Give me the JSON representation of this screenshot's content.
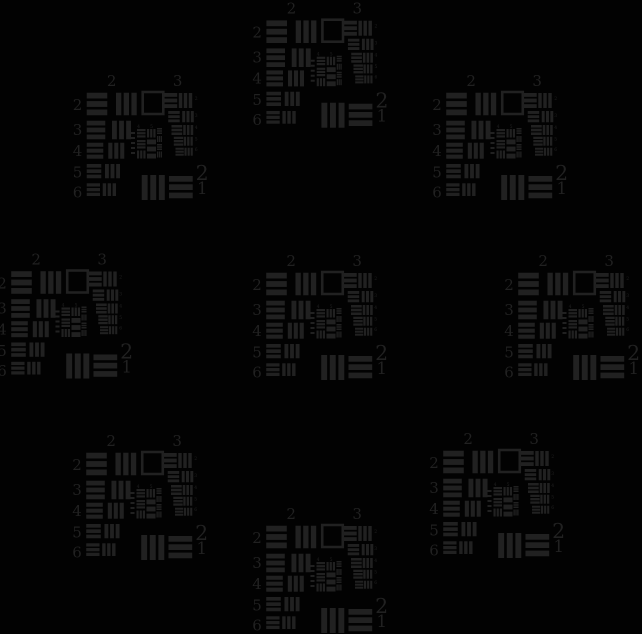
{
  "image": {
    "width": 642,
    "height": 634,
    "background": "#020202",
    "ink": "#212121",
    "description": "USAF 1951 resolution test target tile repeated at 9 positions (center plus ring of 8) on a black background"
  },
  "tile": {
    "width": 140,
    "height": 126,
    "labels": {
      "font_size": 15,
      "top": [
        {
          "text": "2",
          "x": 39.2,
          "y": 11
        },
        {
          "text": "3",
          "x": 105.1,
          "y": 11
        }
      ],
      "left": [
        {
          "text": "2",
          "x": 0.2,
          "y": 35
        },
        {
          "text": "3",
          "x": 0.2,
          "y": 60
        },
        {
          "text": "4",
          "x": 0.2,
          "y": 81
        },
        {
          "text": "5",
          "x": 0.2,
          "y": 102.3
        },
        {
          "text": "6",
          "x": 0.2,
          "y": 122.3
        }
      ],
      "corner": [
        {
          "text": "2",
          "x": 129.7,
          "y": 105,
          "size": 20.5
        },
        {
          "text": "1",
          "x": 129.7,
          "y": 119,
          "size": 16.5
        }
      ],
      "right_ticks": {
        "size": 4.5,
        "x": 122.3,
        "items": [
          {
            "text": "2",
            "y": 25
          },
          {
            "text": "3",
            "y": 42
          },
          {
            "text": "4",
            "y": 54
          },
          {
            "text": "5",
            "y": 65.5
          },
          {
            "text": "6",
            "y": 76
          }
        ]
      },
      "cluster": {
        "size": 4.5,
        "items": [
          {
            "text": "4",
            "x": 66,
            "y": 53
          },
          {
            "text": "5",
            "x": 79,
            "y": 53
          }
        ]
      }
    },
    "open_square": {
      "x": 70.2,
      "y": 17,
      "w": 20.6,
      "h": 22,
      "stroke": 2.6
    },
    "bar_geometry": {
      "bar_fraction": 0.2564,
      "gap_fraction": 0.1154
    },
    "bar_blocks": {
      "group2": [
        {
          "type": "h",
          "x": 14.2,
          "y": 17.7,
          "w": 20.6,
          "h": 22.6
        },
        {
          "type": "v",
          "x": 43.5,
          "y": 17.7,
          "w": 20.7,
          "h": 22.6
        },
        {
          "type": "h",
          "x": 14.2,
          "y": 45.7,
          "w": 18.6,
          "h": 18.6
        },
        {
          "type": "v",
          "x": 39.5,
          "y": 45.7,
          "w": 19.0,
          "h": 18.6
        },
        {
          "type": "h",
          "x": 14.2,
          "y": 67.7,
          "w": 16.6,
          "h": 16.0
        },
        {
          "type": "v",
          "x": 35.8,
          "y": 67.7,
          "w": 16.0,
          "h": 16.0
        },
        {
          "type": "h",
          "x": 14.2,
          "y": 89.0,
          "w": 14.6,
          "h": 14.3
        },
        {
          "type": "v",
          "x": 32.5,
          "y": 89.0,
          "w": 15.0,
          "h": 14.3
        },
        {
          "type": "h",
          "x": 14.2,
          "y": 108.3,
          "w": 13.3,
          "h": 12.7
        },
        {
          "type": "v",
          "x": 30.2,
          "y": 108.3,
          "w": 13.3,
          "h": 12.7
        }
      ],
      "group3": [
        {
          "type": "h",
          "x": 91.3,
          "y": 18.0,
          "w": 13.4,
          "h": 15.0
        },
        {
          "type": "v",
          "x": 106.3,
          "y": 18.0,
          "w": 13.4,
          "h": 15.0
        },
        {
          "type": "h",
          "x": 95.7,
          "y": 36.0,
          "w": 11.5,
          "h": 11.3
        },
        {
          "type": "v",
          "x": 109.7,
          "y": 36.0,
          "w": 11.6,
          "h": 11.3
        },
        {
          "type": "h",
          "x": 99.0,
          "y": 50.0,
          "w": 10.7,
          "h": 10.0
        },
        {
          "type": "v",
          "x": 110.7,
          "y": 50.0,
          "w": 10.0,
          "h": 10.0
        },
        {
          "type": "h",
          "x": 101.3,
          "y": 61.7,
          "w": 9.4,
          "h": 9.0
        },
        {
          "type": "v",
          "x": 111.3,
          "y": 61.7,
          "w": 9.0,
          "h": 9.0
        },
        {
          "type": "h",
          "x": 103.0,
          "y": 72.7,
          "w": 8.3,
          "h": 8.0
        },
        {
          "type": "v",
          "x": 112.0,
          "y": 72.7,
          "w": 8.3,
          "h": 8.0
        }
      ],
      "element1": [
        {
          "type": "v",
          "x": 69.2,
          "y": 100.0,
          "w": 23.1,
          "h": 25.0
        },
        {
          "type": "h",
          "x": 96.5,
          "y": 101.0,
          "w": 23.7,
          "h": 22.3
        }
      ],
      "cluster": [
        {
          "type": "h",
          "x": 64.5,
          "y": 54.0,
          "w": 8.5,
          "h": 8.5
        },
        {
          "type": "v",
          "x": 74.5,
          "y": 54.0,
          "w": 8.5,
          "h": 8.5
        },
        {
          "type": "h",
          "x": 64.5,
          "y": 65.0,
          "w": 8.5,
          "h": 8.5
        },
        {
          "type": "h",
          "x": 74.5,
          "y": 64.5,
          "w": 9.0,
          "h": 19.0
        },
        {
          "type": "v",
          "x": 64.5,
          "y": 75.5,
          "w": 8.5,
          "h": 8.0
        },
        {
          "type": "h",
          "x": 84.5,
          "y": 53.0,
          "w": 5.0,
          "h": 6.0
        },
        {
          "type": "v",
          "x": 84.5,
          "y": 61.0,
          "w": 5.0,
          "h": 6.0
        },
        {
          "type": "h",
          "x": 84.5,
          "y": 69.0,
          "w": 5.0,
          "h": 6.0
        },
        {
          "type": "v",
          "x": 84.5,
          "y": 76.5,
          "w": 5.0,
          "h": 6.0
        }
      ]
    },
    "cluster_ticks": [
      [
        58.5,
        57,
        4,
        2
      ],
      [
        58.5,
        62,
        4,
        2
      ],
      [
        58.5,
        67,
        4,
        2
      ],
      [
        58.5,
        72,
        4,
        2
      ],
      [
        58.5,
        77,
        4,
        2
      ]
    ]
  },
  "tiles": [
    {
      "name": "top-center",
      "x": 252.2,
      "y": 2.7
    },
    {
      "name": "top-left",
      "x": 72.5,
      "y": 75
    },
    {
      "name": "top-right",
      "x": 432,
      "y": 75
    },
    {
      "name": "middle-left",
      "x": -3,
      "y": 253.5
    },
    {
      "name": "center",
      "x": 252,
      "y": 255
    },
    {
      "name": "middle-right",
      "x": 504,
      "y": 255
    },
    {
      "name": "bottom-left",
      "x": 72,
      "y": 435
    },
    {
      "name": "bottom-center",
      "x": 252,
      "y": 508
    },
    {
      "name": "bottom-right",
      "x": 429,
      "y": 433
    }
  ]
}
